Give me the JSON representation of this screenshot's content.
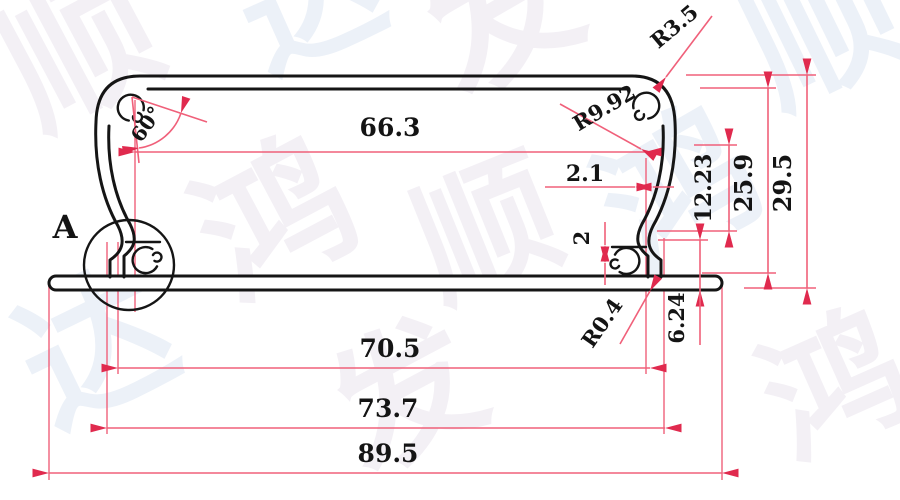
{
  "dims": {
    "inner_top_width": "66.3",
    "top_wall_thickness": "2.1",
    "side_recess_height": "12.23",
    "inner_height": "25.9",
    "overall_height": "29.5",
    "base_step": "2",
    "base_edge_height": "6.24",
    "base_inner_width": "70.5",
    "base_outer_width": "73.7",
    "overall_width": "89.5",
    "boss_angle": "60°",
    "corner_radius": "R3.5",
    "wall_radius": "R9.92",
    "base_fillet_radius": "R0.4"
  },
  "labels": {
    "detail_view": "A"
  },
  "watermark": {
    "w1": "顺",
    "w2": "达",
    "w3": "发",
    "w4": "顺",
    "w5": "鸿",
    "w6": "顺",
    "w7": "鸿",
    "w8": "达",
    "w9": "发",
    "w10": "鸿"
  },
  "colors": {
    "background": "#ffffff",
    "outline": "#151515",
    "text": "#141414",
    "dimension_line": "#f0607a",
    "dimension_accent": "#e02a4e",
    "watermark_pink": "#eae4ee",
    "watermark_blue": "#dde6f3"
  }
}
